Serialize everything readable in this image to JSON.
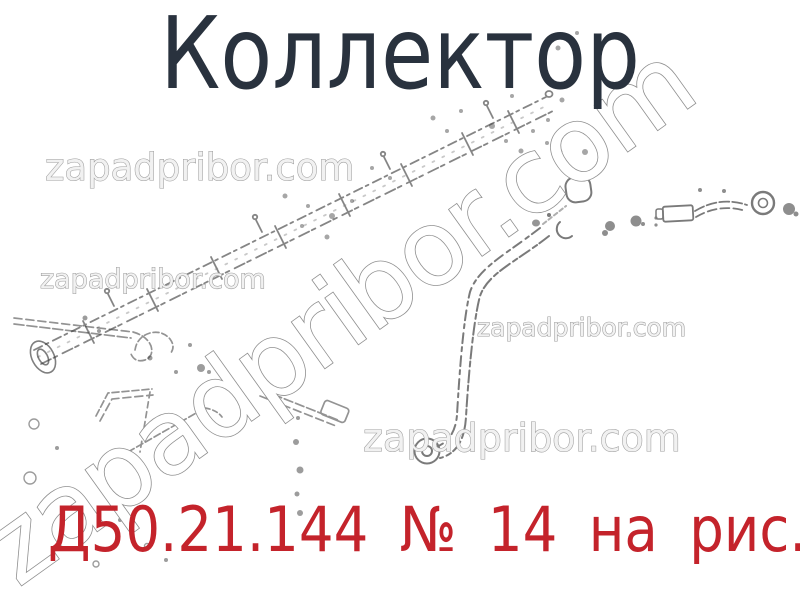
{
  "page": {
    "title": "Коллектор",
    "caption": "Д50.21.144 № 14 на рис."
  },
  "watermark": {
    "text": "zapadpribor.com",
    "small_count": 4,
    "large_diagonal": true
  },
  "figure": {
    "type": "technical-line-drawing",
    "subject": "Коллектор"
  },
  "colors": {
    "background": "#ffffff",
    "title_text": "#29323e",
    "caption_text": "#c4232b",
    "watermark_outline": "#9c9c9c",
    "drawing_line": "#3c3c3c"
  }
}
